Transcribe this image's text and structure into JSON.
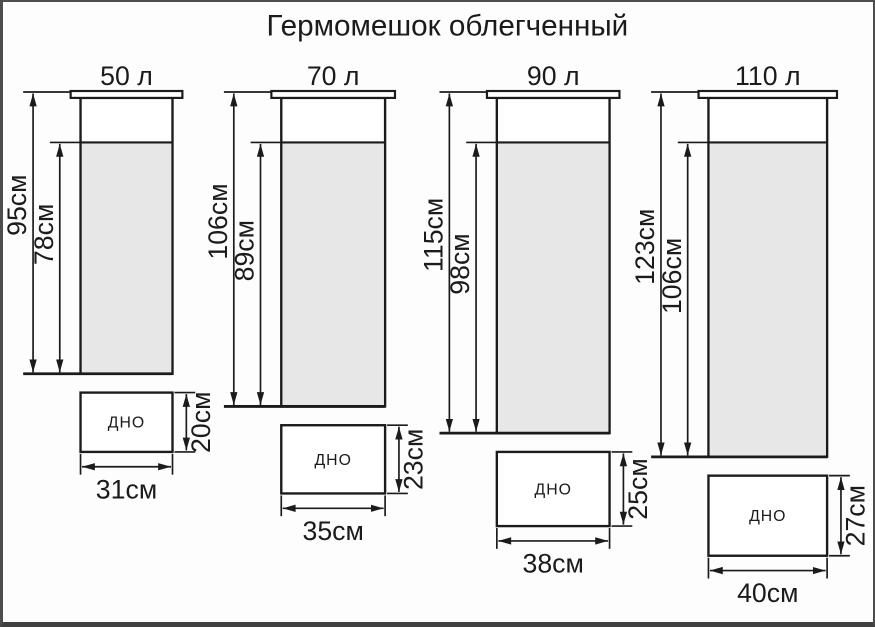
{
  "title": "Гермомешок облегченный",
  "bottom_face_label": "ДНО",
  "diagram": {
    "type": "dimension-drawing",
    "scale_px_per_cm": 3,
    "line_color": "#1b1b1b",
    "fill_color": "#e7e7e7",
    "background_color": "#fdfdfd",
    "frame_color": "#4d4d4d"
  },
  "bags": [
    {
      "volume_label": "50 л",
      "outer_height_cm": 95,
      "outer_height_label": "95см",
      "inner_height_cm": 78,
      "inner_height_label": "78см",
      "bottom_width_cm": 31,
      "bottom_width_label": "31см",
      "bottom_depth_cm": 20,
      "bottom_depth_label": "20см",
      "x": 76
    },
    {
      "volume_label": "70 л",
      "outer_height_cm": 106,
      "outer_height_label": "106см",
      "inner_height_cm": 89,
      "inner_height_label": "89см",
      "bottom_width_cm": 35,
      "bottom_width_label": "35см",
      "bottom_depth_cm": 23,
      "bottom_depth_label": "23см",
      "x": 279
    },
    {
      "volume_label": "90 л",
      "outer_height_cm": 115,
      "outer_height_label": "115см",
      "inner_height_cm": 98,
      "inner_height_label": "98см",
      "bottom_width_cm": 38,
      "bottom_width_label": "38см",
      "bottom_depth_cm": 25,
      "bottom_depth_label": "25см",
      "x": 497
    },
    {
      "volume_label": "110 л",
      "outer_height_cm": 123,
      "outer_height_label": "123см",
      "inner_height_cm": 106,
      "inner_height_label": "106см",
      "bottom_width_cm": 40,
      "bottom_width_label": "40см",
      "bottom_depth_cm": 27,
      "bottom_depth_label": "27см",
      "x": 711
    }
  ]
}
